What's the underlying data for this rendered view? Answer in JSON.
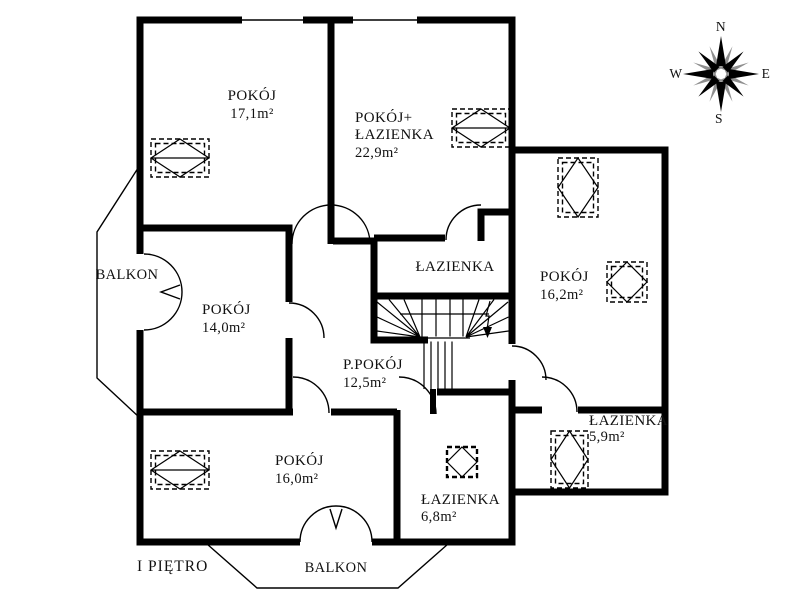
{
  "floor_label": "I PIĘTRO",
  "compass": {
    "north": "N",
    "east": "E",
    "south": "S",
    "west": "W"
  },
  "rooms": {
    "pokoj_17": {
      "name": "POKÓJ",
      "area": "17,1m²"
    },
    "pokoj_lazienka_22": {
      "name_line1": "POKÓJ+",
      "name_line2": "ŁAZIENKA",
      "area": "22,9m²"
    },
    "pokoj_16_2": {
      "name": "POKÓJ",
      "area": "16,2m²"
    },
    "lazienka_middle": {
      "name": "ŁAZIENKA"
    },
    "pokoj_14": {
      "name": "POKÓJ",
      "area": "14,0m²"
    },
    "p_pokoj_12": {
      "name": "P.POKÓJ",
      "area": "12,5m²"
    },
    "pokoj_16_0": {
      "name": "POKÓJ",
      "area": "16,0m²"
    },
    "lazienka_6_8": {
      "name": "ŁAZIENKA",
      "area": "6,8m²"
    },
    "lazienka_5_9": {
      "name": "ŁAZIENKA",
      "area": "5,9m²"
    }
  },
  "balconies": {
    "left": {
      "label": "BALKON"
    },
    "bottom": {
      "label": "BALKON"
    }
  },
  "colors": {
    "wall": "#000000",
    "background": "#ffffff",
    "compass_secondary": "#8f8f8f",
    "text": "#111111"
  }
}
